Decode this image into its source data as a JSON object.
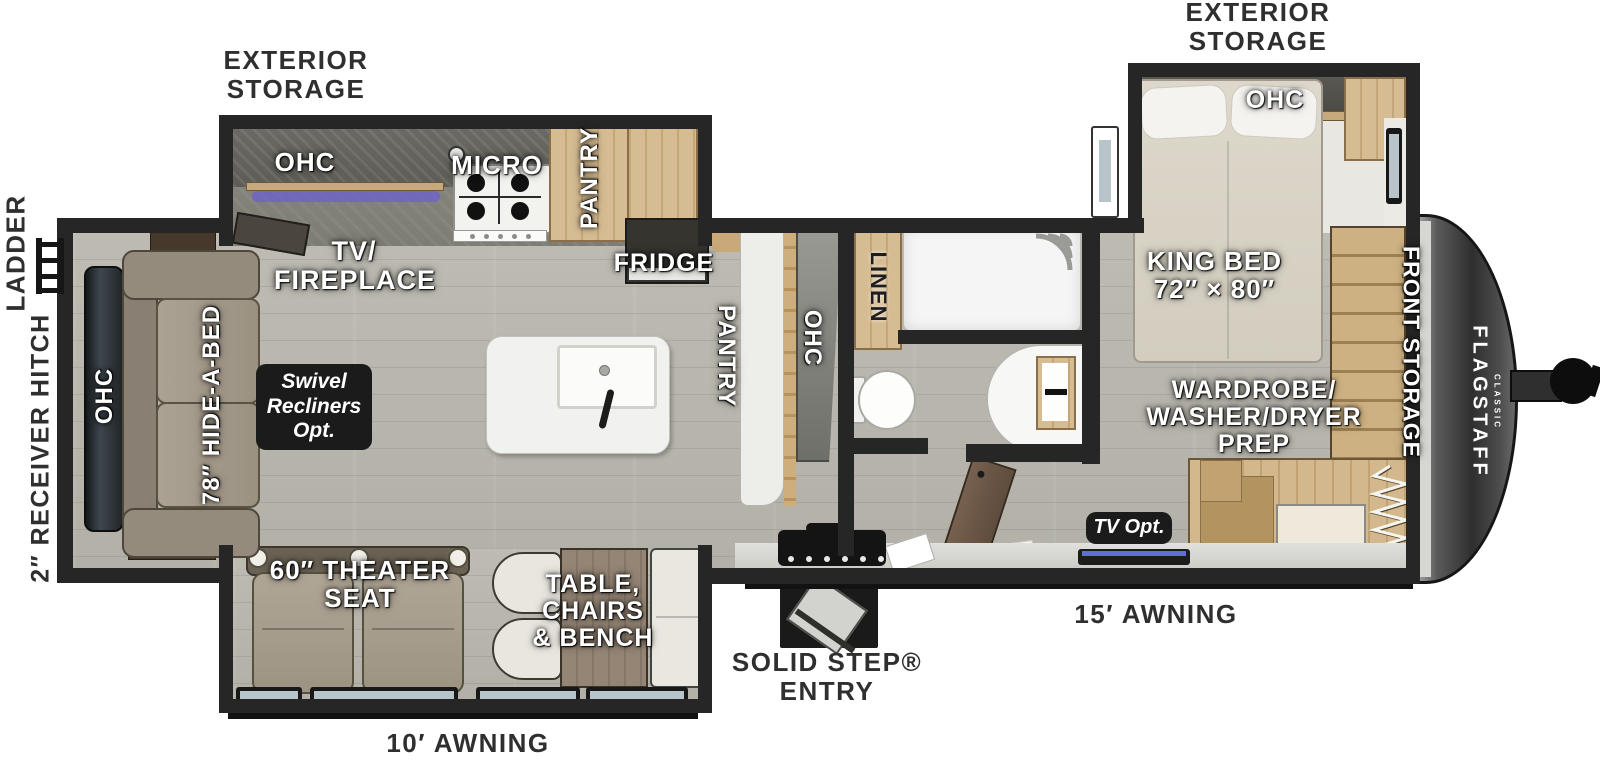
{
  "colors": {
    "wall": "#262626",
    "floor": "#b8b6ad",
    "wood": "#cfb286",
    "wood-dark": "#8a6f4a",
    "badge": "#1b1b1b",
    "cap": "#3a3a3a",
    "glass": "#b7c5cb",
    "fixture": "#f4f4f2",
    "sofa": "#a49a89",
    "ink": "#2f2f2f"
  },
  "exterior": {
    "storage_left": {
      "lines": [
        "EXTERIOR",
        "STORAGE"
      ]
    },
    "storage_right": {
      "lines": [
        "EXTERIOR",
        "STORAGE"
      ]
    },
    "ladder": "LADDER",
    "receiver_hitch": "2″ RECEIVER HITCH",
    "solid_step": {
      "lines": [
        "SOLID STEP®",
        "ENTRY"
      ]
    },
    "awning_door": "15′ AWNING",
    "awning_rear": "10′ AWNING"
  },
  "front": {
    "brand": "FLAGSTAFF",
    "series": "CLASSIC",
    "storage": "FRONT STORAGE"
  },
  "bedroom": {
    "ohc": "OHC",
    "bed": {
      "lines": [
        "KING BED",
        "72″ × 80″"
      ]
    },
    "wardrobe": {
      "lines": [
        "WARDROBE/",
        "WASHER/DRYER",
        "PREP"
      ]
    },
    "tv_opt": "TV Opt."
  },
  "bath": {
    "linen": "LINEN"
  },
  "kitchen": {
    "ohc": "OHC",
    "micro": "MICRO",
    "pantry": "PANTRY",
    "fridge": "FRIDGE",
    "hall_pantry": "PANTRY",
    "hall_ohc": "OHC",
    "tv_fireplace": {
      "lines": [
        "TV/",
        "FIREPLACE"
      ]
    }
  },
  "living": {
    "ohc": "OHC",
    "hide_a_bed": "78″ HIDE-A-BED",
    "swivel_badge": {
      "lines": [
        "Swivel",
        "Recliners",
        "Opt."
      ]
    },
    "theater": {
      "lines": [
        "60″ THEATER",
        "SEAT"
      ]
    },
    "dinette": {
      "lines": [
        "TABLE,",
        "CHAIRS",
        "& BENCH"
      ]
    }
  }
}
